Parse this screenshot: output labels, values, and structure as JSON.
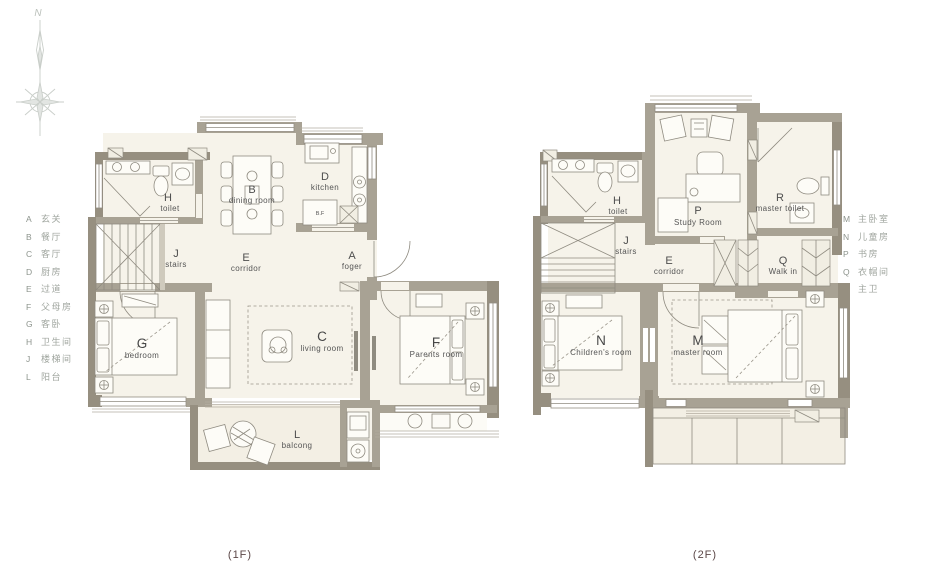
{
  "compass": {
    "north": "N"
  },
  "legend_left": {
    "items": [
      {
        "key": "A",
        "label": "玄关"
      },
      {
        "key": "B",
        "label": "餐厅"
      },
      {
        "key": "C",
        "label": "客厅"
      },
      {
        "key": "D",
        "label": "厨房"
      },
      {
        "key": "E",
        "label": "过道"
      },
      {
        "key": "F",
        "label": "父母房"
      },
      {
        "key": "G",
        "label": "客卧"
      },
      {
        "key": "H",
        "label": "卫生间"
      },
      {
        "key": "J",
        "label": "楼梯间"
      },
      {
        "key": "L",
        "label": "阳台"
      }
    ]
  },
  "legend_right": {
    "items": [
      {
        "key": "M",
        "label": "主卧室"
      },
      {
        "key": "N",
        "label": "儿童房"
      },
      {
        "key": "P",
        "label": "书房"
      },
      {
        "key": "Q",
        "label": "衣帽间"
      },
      {
        "key": "R",
        "label": "主卫"
      }
    ]
  },
  "floor1": {
    "caption": "(1F)",
    "rooms": {
      "foyer": {
        "key": "A",
        "name": "foger"
      },
      "dining": {
        "key": "B",
        "name": "dining room"
      },
      "living": {
        "key": "C",
        "name": "living room"
      },
      "kitchen": {
        "key": "D",
        "name": "kitchen"
      },
      "corridor": {
        "key": "E",
        "name": "corridor"
      },
      "parents": {
        "key": "F",
        "name": "Parents room"
      },
      "bedroom": {
        "key": "G",
        "name": "bedroom"
      },
      "toilet": {
        "key": "H",
        "name": "toilet"
      },
      "stairs": {
        "key": "J",
        "name": "stairs"
      },
      "balcony": {
        "key": "L",
        "name": "balcong"
      }
    },
    "labels": {
      "fridge": "B.F"
    }
  },
  "floor2": {
    "caption": "(2F)",
    "rooms": {
      "master": {
        "key": "M",
        "name": "master room"
      },
      "children": {
        "key": "N",
        "name": "Children's room"
      },
      "study": {
        "key": "P",
        "name": "Study Room"
      },
      "walkin": {
        "key": "Q",
        "name": "Walk in"
      },
      "master_toilet": {
        "key": "R",
        "name": "master toilet"
      },
      "toilet": {
        "key": "H",
        "name": "toilet"
      },
      "stairs": {
        "key": "J",
        "name": "stairs"
      },
      "corridor": {
        "key": "E",
        "name": "corridor"
      }
    }
  }
}
